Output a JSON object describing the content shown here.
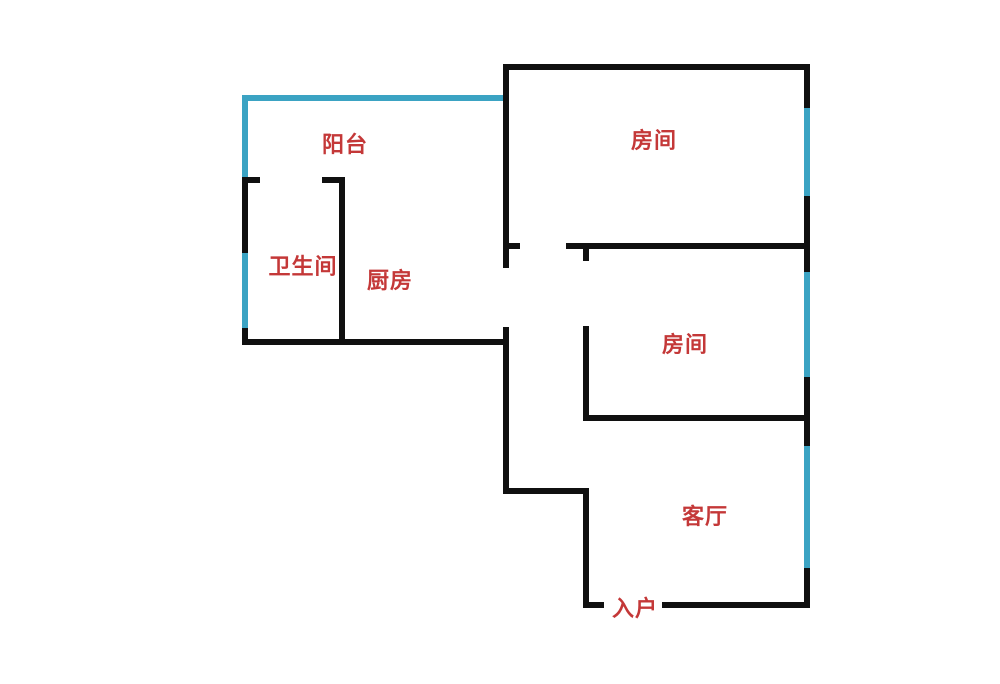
{
  "meta": {
    "type": "apartment-floor-plan"
  },
  "canvas": {
    "width": 1000,
    "height": 684,
    "background": "#FFFFFF"
  },
  "colors": {
    "wall": "#101010",
    "window": "#3BA3C3",
    "label_text": "#C43838"
  },
  "label_font_px": 22,
  "rooms": [
    {
      "id": "balcony",
      "label": "阳台",
      "cx": 345,
      "cy": 146
    },
    {
      "id": "room-1",
      "label": "房间",
      "cx": 654,
      "cy": 142
    },
    {
      "id": "bathroom",
      "label": "卫生间",
      "cx": 303,
      "cy": 268
    },
    {
      "id": "kitchen",
      "label": "厨房",
      "cx": 390,
      "cy": 282
    },
    {
      "id": "room-2",
      "label": "房间",
      "cx": 685,
      "cy": 346
    },
    {
      "id": "living-room",
      "label": "客厅",
      "cx": 705,
      "cy": 518
    },
    {
      "id": "entrance",
      "label": "入户",
      "cx": 635,
      "cy": 610
    }
  ],
  "walls": [
    {
      "id": "room1-top-wall",
      "x": 503,
      "y": 64,
      "w": 307,
      "h": 6
    },
    {
      "id": "right-wall-seg-1",
      "x": 804,
      "y": 64,
      "w": 6,
      "h": 44
    },
    {
      "id": "right-wall-seg-2",
      "x": 804,
      "y": 196,
      "w": 6,
      "h": 76
    },
    {
      "id": "right-wall-seg-3",
      "x": 804,
      "y": 377,
      "w": 6,
      "h": 69
    },
    {
      "id": "right-wall-seg-4",
      "x": 804,
      "y": 568,
      "w": 6,
      "h": 40
    },
    {
      "id": "center-spine-upper",
      "x": 503,
      "y": 64,
      "w": 6,
      "h": 204
    },
    {
      "id": "center-spine-tick",
      "x": 503,
      "y": 243,
      "w": 17,
      "h": 6
    },
    {
      "id": "mid-horizontal-wall",
      "x": 566,
      "y": 243,
      "w": 244,
      "h": 6
    },
    {
      "id": "room2-left-tick",
      "x": 583,
      "y": 243,
      "w": 6,
      "h": 18
    },
    {
      "id": "room2-left-wall",
      "x": 583,
      "y": 326,
      "w": 6,
      "h": 95
    },
    {
      "id": "room2-bottom-wall",
      "x": 583,
      "y": 415,
      "w": 227,
      "h": 6
    },
    {
      "id": "center-spine-lower",
      "x": 503,
      "y": 327,
      "w": 6,
      "h": 167
    },
    {
      "id": "hall-step-wall",
      "x": 503,
      "y": 488,
      "w": 86,
      "h": 6
    },
    {
      "id": "living-left-wall",
      "x": 583,
      "y": 488,
      "w": 6,
      "h": 120
    },
    {
      "id": "bottom-wall-left-stub",
      "x": 583,
      "y": 602,
      "w": 21,
      "h": 6
    },
    {
      "id": "bottom-wall-right",
      "x": 662,
      "y": 602,
      "w": 148,
      "h": 6
    },
    {
      "id": "kitchen-bottom-wall",
      "x": 242,
      "y": 339,
      "w": 267,
      "h": 6
    },
    {
      "id": "bath-left-upper",
      "x": 242,
      "y": 177,
      "w": 6,
      "h": 76
    },
    {
      "id": "bath-left-lower",
      "x": 242,
      "y": 328,
      "w": 6,
      "h": 17
    },
    {
      "id": "bath-top-left-tick",
      "x": 242,
      "y": 177,
      "w": 18,
      "h": 6
    },
    {
      "id": "bath-top-right-tick",
      "x": 322,
      "y": 177,
      "w": 23,
      "h": 6
    },
    {
      "id": "bath-right-wall",
      "x": 339,
      "y": 177,
      "w": 6,
      "h": 168
    }
  ],
  "windows": [
    {
      "id": "balcony-top-window",
      "x": 242,
      "y": 95,
      "w": 261,
      "h": 6
    },
    {
      "id": "balcony-left-window",
      "x": 242,
      "y": 95,
      "w": 6,
      "h": 82
    },
    {
      "id": "bath-left-window",
      "x": 242,
      "y": 253,
      "w": 6,
      "h": 75
    },
    {
      "id": "right-window-1",
      "x": 804,
      "y": 108,
      "w": 6,
      "h": 88
    },
    {
      "id": "right-window-2",
      "x": 804,
      "y": 272,
      "w": 6,
      "h": 105
    },
    {
      "id": "right-window-3",
      "x": 804,
      "y": 446,
      "w": 6,
      "h": 122
    }
  ]
}
